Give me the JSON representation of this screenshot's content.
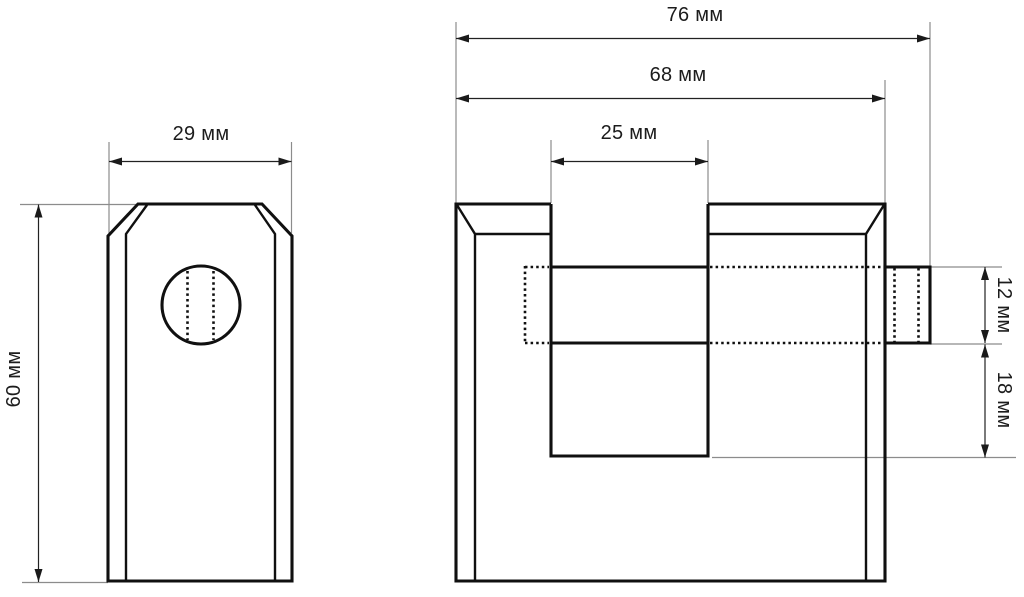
{
  "drawing": {
    "type": "technical-drawing",
    "subject": "padlock two-view dimensioned drawing",
    "unit": "мм",
    "colors": {
      "line": "#101010",
      "extension_line": "#8c8c8c",
      "dimension_line": "#222222",
      "background": "#ffffff",
      "text": "#1c1c1c"
    },
    "side_view": {
      "dimensions": {
        "width": {
          "value": 29,
          "label": "29 мм",
          "orientation": "horizontal"
        },
        "height": {
          "value": 60,
          "label": "60 мм",
          "orientation": "vertical"
        }
      }
    },
    "front_view": {
      "dimensions": {
        "overall_width": {
          "value": 76,
          "label": "76 мм",
          "orientation": "horizontal"
        },
        "body_width": {
          "value": 68,
          "label": "68 мм",
          "orientation": "horizontal"
        },
        "slot_width": {
          "value": 25,
          "label": "25 мм",
          "orientation": "horizontal"
        },
        "bolt_height": {
          "value": 12,
          "label": "12 мм",
          "orientation": "vertical"
        },
        "slot_depth_below_bolt": {
          "value": 18,
          "label": "18 мм",
          "orientation": "vertical"
        }
      }
    }
  }
}
